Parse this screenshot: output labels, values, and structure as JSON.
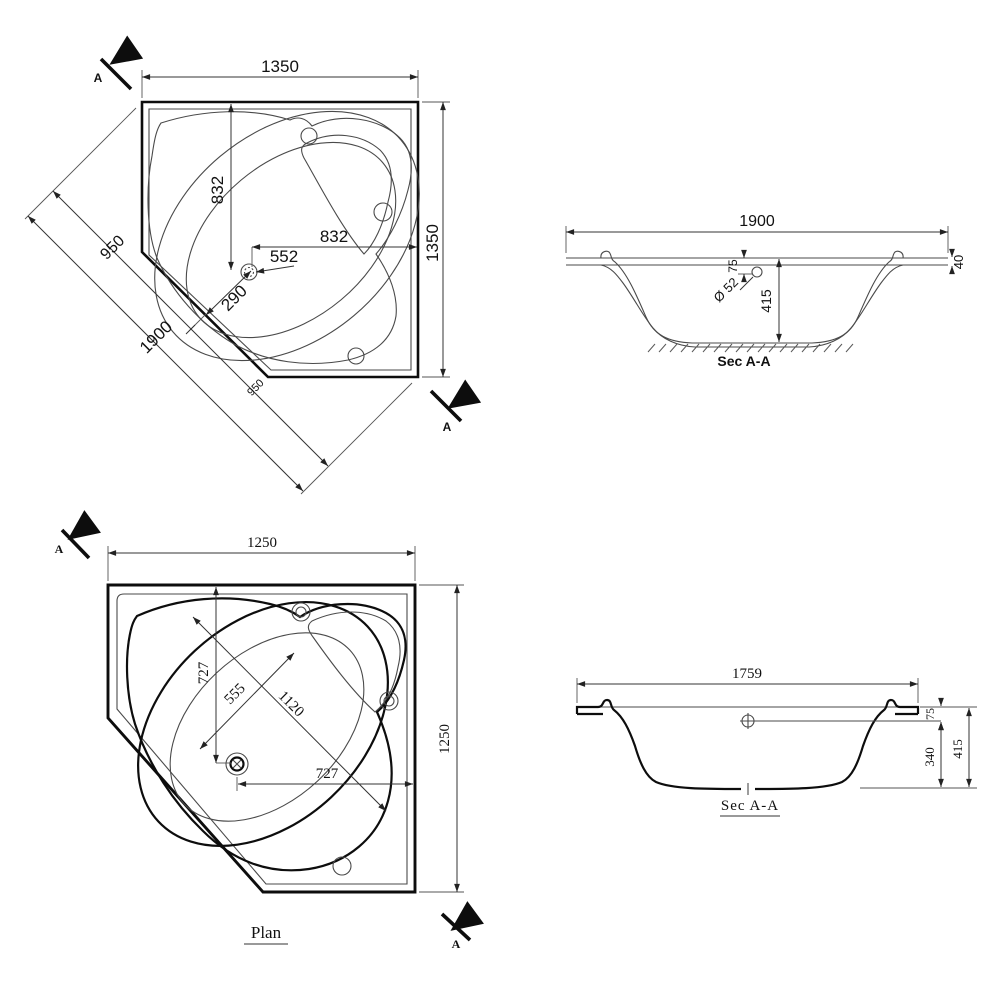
{
  "sheet": {
    "background": "#ffffff",
    "line_color": "#0d0d0d",
    "thin_line_color": "#4a4a4a"
  },
  "plan_large": {
    "section_marker_top": "A",
    "section_marker_bottom": "A",
    "dim_top_width": "1350",
    "dim_right_height": "1350",
    "dim_center_vertical": "832",
    "dim_center_horizontal": "832",
    "dim_drain_offset": "552",
    "dim_drain_to_edge": "290",
    "dim_diag_half_upper": "950",
    "dim_diag_total": "1900",
    "dim_diag_half_lower": "950"
  },
  "section_large": {
    "title": "Sec A-A",
    "dim_width": "1900",
    "dim_rim_to_drain": "75",
    "dim_drain_diameter": "Ø 52",
    "dim_depth": "415",
    "dim_rim_thickness": "40"
  },
  "plan_small": {
    "title": "Plan",
    "section_marker_top": "A",
    "section_marker_bottom": "A",
    "dim_top_width": "1250",
    "dim_right_height": "1250",
    "dim_center_vertical": "727",
    "dim_center_horizontal": "727",
    "dim_diag_width": "555",
    "dim_diag_length": "1120"
  },
  "section_small": {
    "title": "Sec A-A",
    "dim_width": "1759",
    "dim_rim_to_center": "75",
    "dim_inner_depth": "340",
    "dim_total_depth": "415"
  }
}
